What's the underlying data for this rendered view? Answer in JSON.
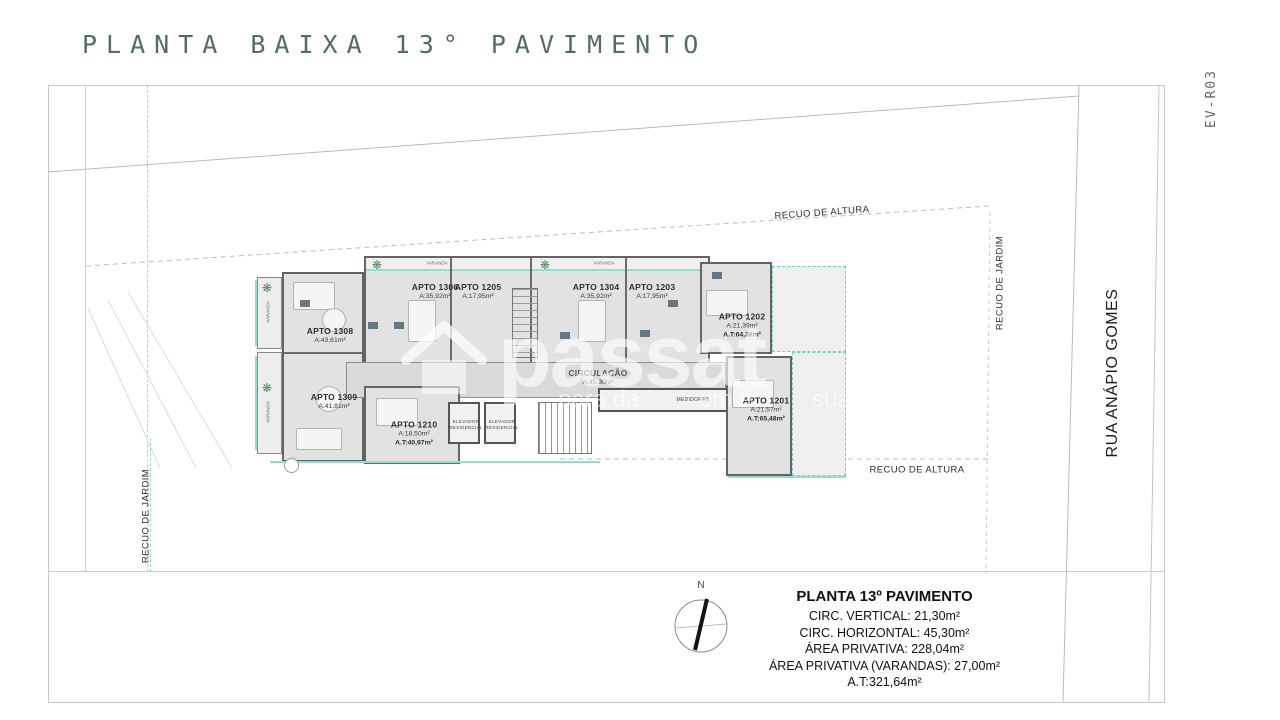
{
  "title": "PLANTA BAIXA 13° PAVIMENTO",
  "revision": "EV-R03",
  "street": "RUA ANÁPIO GOMES",
  "setbacks": {
    "altura_top": "RECUO DE ALTURA",
    "altura_bottom": "RECUO DE ALTURA",
    "jardim_left": "RECUO DE JARDIM",
    "jardim_right": "RECUO DE JARDIM"
  },
  "apartments": [
    {
      "name": "APTO 1308",
      "area": "A:43,61m²"
    },
    {
      "name": "APTO 1309",
      "area": "A:41,81m²"
    },
    {
      "name": "APTO 1210",
      "area": "A:18,50m²",
      "total": "A.T:40,97m²"
    },
    {
      "name": "APTO 1306",
      "area": "A:35,92m²"
    },
    {
      "name": "APTO 1205",
      "area": "A:17,95m²"
    },
    {
      "name": "APTO 1304",
      "area": "A:35,92m²"
    },
    {
      "name": "APTO 1203",
      "area": "A:17,95m²"
    },
    {
      "name": "APTO 1202",
      "area": "A:21,39m²",
      "total": "A.T:64,38m²"
    },
    {
      "name": "APTO 1201",
      "area": "A:21,57m²",
      "total": "A.T:65,48m²"
    }
  ],
  "rooms": {
    "circulacao": {
      "name": "CIRCULAÇÃO",
      "area": "A:45,30m²"
    },
    "medidores": "MEDIDORES",
    "elevator": {
      "line1": "ELEVADOR",
      "line2": "RESIDENCIAL"
    },
    "varanda": "VARANDA"
  },
  "compass": {
    "north": "N"
  },
  "summary": {
    "title": "PLANTA 13º PAVIMENTO",
    "lines": [
      "CIRC. VERTICAL: 21,30m²",
      "CIRC. HORIZONTAL: 45,30m²",
      "ÁREA PRIVATIVA: 228,04m²",
      "ÁREA PRIVATIVA (VARANDAS): 27,00m²",
      "A.T:321,64m²"
    ]
  },
  "watermark": {
    "brand": "passat",
    "fragments": [
      "para da",
      "em e",
      "sua vid"
    ]
  },
  "icons": {
    "plant": "❋"
  },
  "colors": {
    "title": "#516e62",
    "accent_teal": "#8fe0d4",
    "wall": "#646464",
    "fixture": "#4a6471"
  }
}
